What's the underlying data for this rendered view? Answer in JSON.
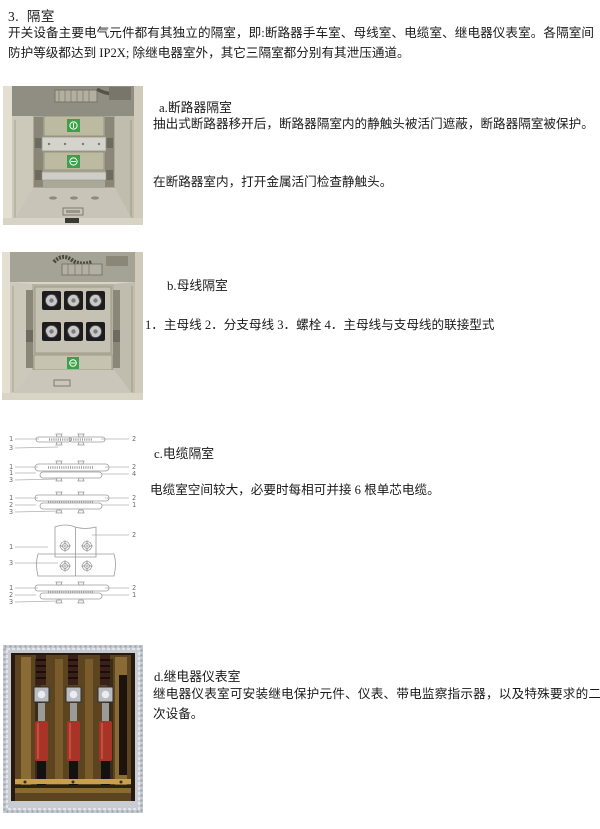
{
  "page": {
    "title": "3.  隔室",
    "intro": "开关设备主要电气元件都有其独立的隔室，即:断路器手车室、母线室、电缆室、继电器仪表室。各隔室间防护等级都达到 IP2X; 除继电器室外，其它三隔室都分别有其泄压通道。"
  },
  "sections": {
    "a": {
      "heading": "a.断路器隔室",
      "para1": "抽出式断路器移开后，断路器隔室内的静触头被活门遮蔽，断路器隔室被保护。",
      "para2": "在断路器室内，打开金属活门检查静触头。"
    },
    "b": {
      "heading": "b.母线隔室",
      "legend": "1．主母线 2．分支母线 3．螺栓 4．主母线与支母线的联接型式"
    },
    "c": {
      "heading": "c.电缆隔室",
      "para": "电缆室空间较大，必要时每相可并接 6 根单芯电缆。"
    },
    "d": {
      "heading": "d.继电器仪表室",
      "para": "继电器仪表室可安装继电保护元件、仪表、带电监察指示器，以及特殊要求的二次设备。"
    }
  },
  "cable_diagram": {
    "d1": {
      "l1": "1",
      "l2": "3",
      "r1": "2"
    },
    "d2": {
      "l1": "1",
      "l2": "1",
      "l3": "3",
      "r1": "2",
      "r2": "4"
    },
    "d3": {
      "l1": "1",
      "l2": "2",
      "l3": "3",
      "r1": "2",
      "r2": "1"
    },
    "d4": {
      "l1": "1",
      "l2": "3",
      "r1": "2"
    },
    "d5": {
      "l1": "1",
      "l2": "2",
      "l3": "3",
      "r1": "2",
      "r2": "1"
    }
  },
  "colors": {
    "label_green": "#3ca14a",
    "cabinet_beige": "#d8d4c5",
    "insulator_red": "#a83428"
  }
}
